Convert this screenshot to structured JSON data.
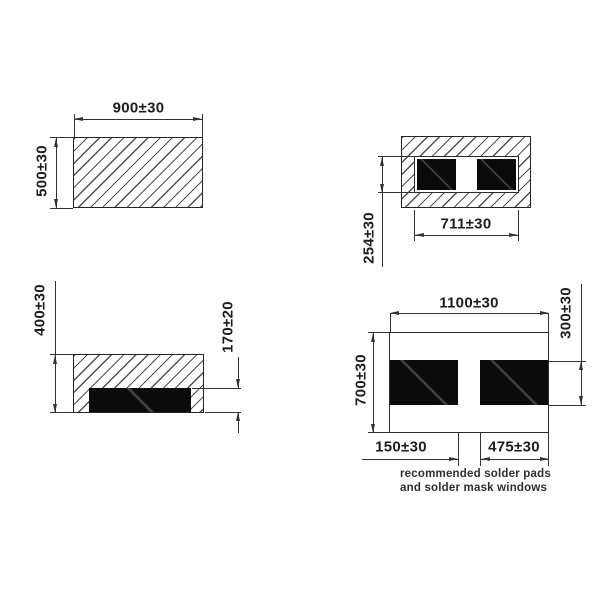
{
  "drawing_title": "component package dimension drawing",
  "dims": {
    "top_view_width": "900±30",
    "top_view_height": "500±30",
    "bottom_view_window_width": "711±30",
    "bottom_view_window_height": "254±30",
    "side_view_height": "400±30",
    "side_view_emitter_height": "170±20",
    "pads_overall_width": "1100±30",
    "pads_overall_height": "700±30",
    "pad_height": "300±30",
    "pad_gap": "150±30",
    "pad_width": "475±30"
  },
  "caption": {
    "line1": "recommended solder pads",
    "line2": "and solder mask windows"
  },
  "colors": {
    "line": "#333333",
    "pad_fill": "#0b0b0b",
    "background": "#ffffff"
  }
}
